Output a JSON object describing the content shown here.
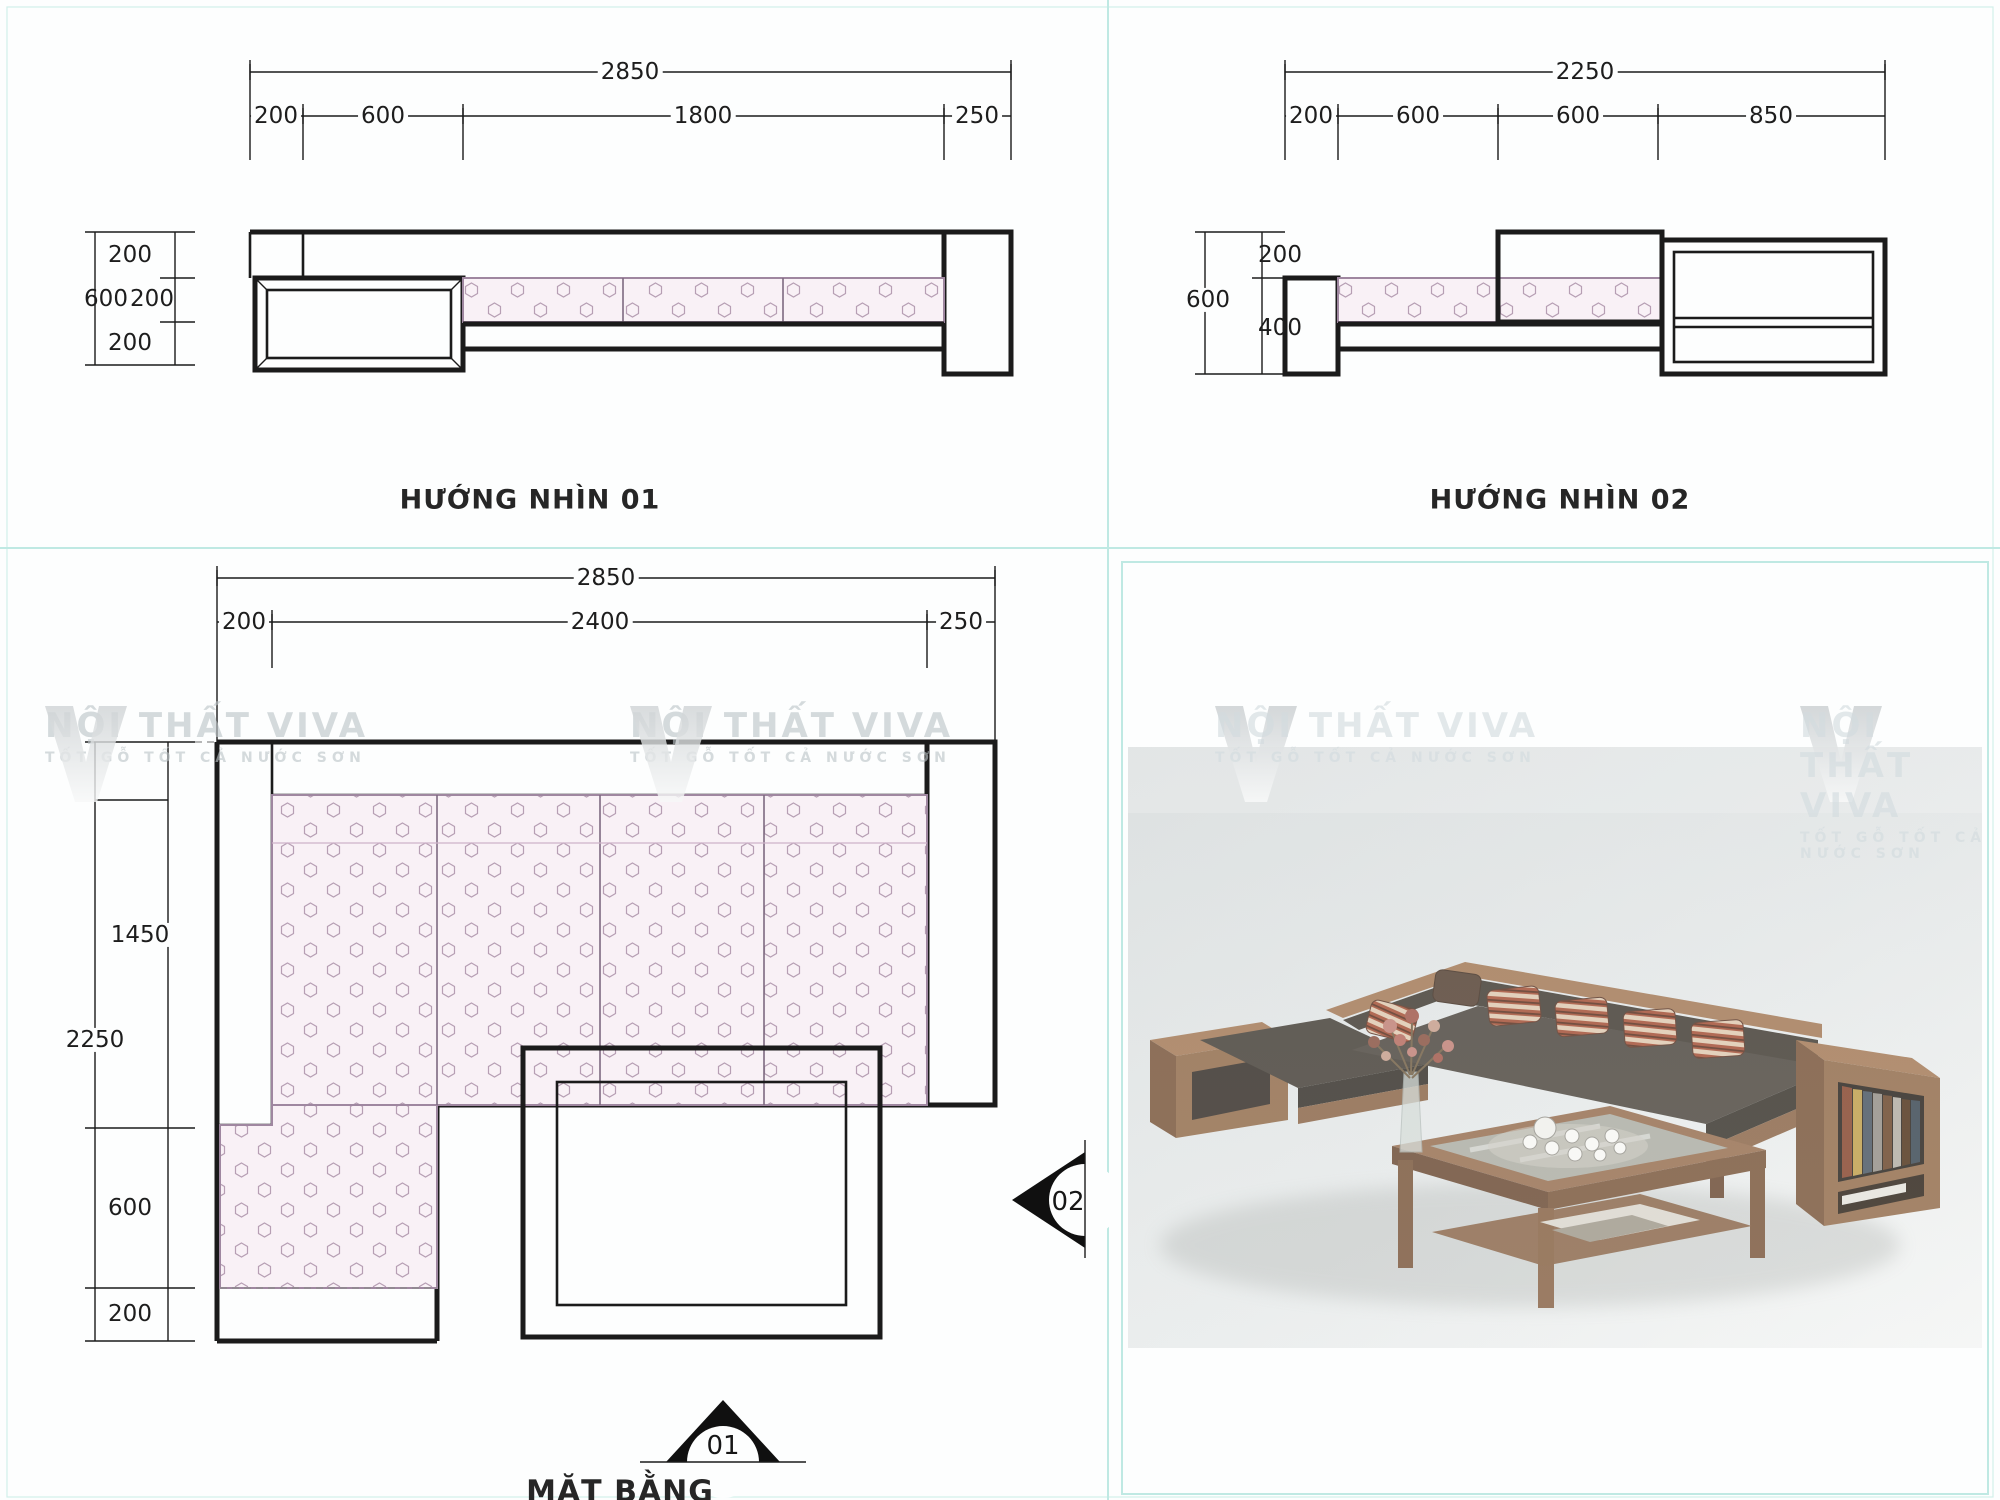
{
  "colors": {
    "line": "#1b1b1b",
    "teal": "#bfe9e3",
    "cushion_fill": "#f9f1f6",
    "cushion_stroke": "#b79fb4",
    "glass_line": "#def2f4",
    "wood": "#9a7254",
    "wood_dark": "#7d5a3f",
    "cushion_photo": "#4a443c",
    "photo_bg": "#e4e7e6",
    "watermark": "#bcc4c7"
  },
  "view1": {
    "caption": "HƯỚNG NHÌN 01",
    "dim_total": "2850",
    "dim_segments": [
      "200",
      "600",
      "1800",
      "250"
    ],
    "dim_left": {
      "top": "200",
      "outer": "600",
      "mid": "200",
      "bottom": "200"
    }
  },
  "view2": {
    "caption": "HƯỚNG NHÌN 02",
    "dim_total": "2250",
    "dim_segments": [
      "200",
      "600",
      "600",
      "850"
    ],
    "dim_left": {
      "top": "200",
      "outer": "600",
      "bottom": "400"
    }
  },
  "plan": {
    "caption": "MẶT BẰNG",
    "dim_total": "2850",
    "dim_segments": [
      "200",
      "2400",
      "250"
    ],
    "dim_left": {
      "seg1": "1450",
      "outer": "2250",
      "seg2": "600",
      "seg3": "200"
    },
    "marker_bottom": "01",
    "marker_right": "02"
  },
  "watermark": {
    "brand": "NỘI THẤT VIVA",
    "slogan": "TỐT GỖ TỐT CẢ NƯỚC SƠN"
  }
}
